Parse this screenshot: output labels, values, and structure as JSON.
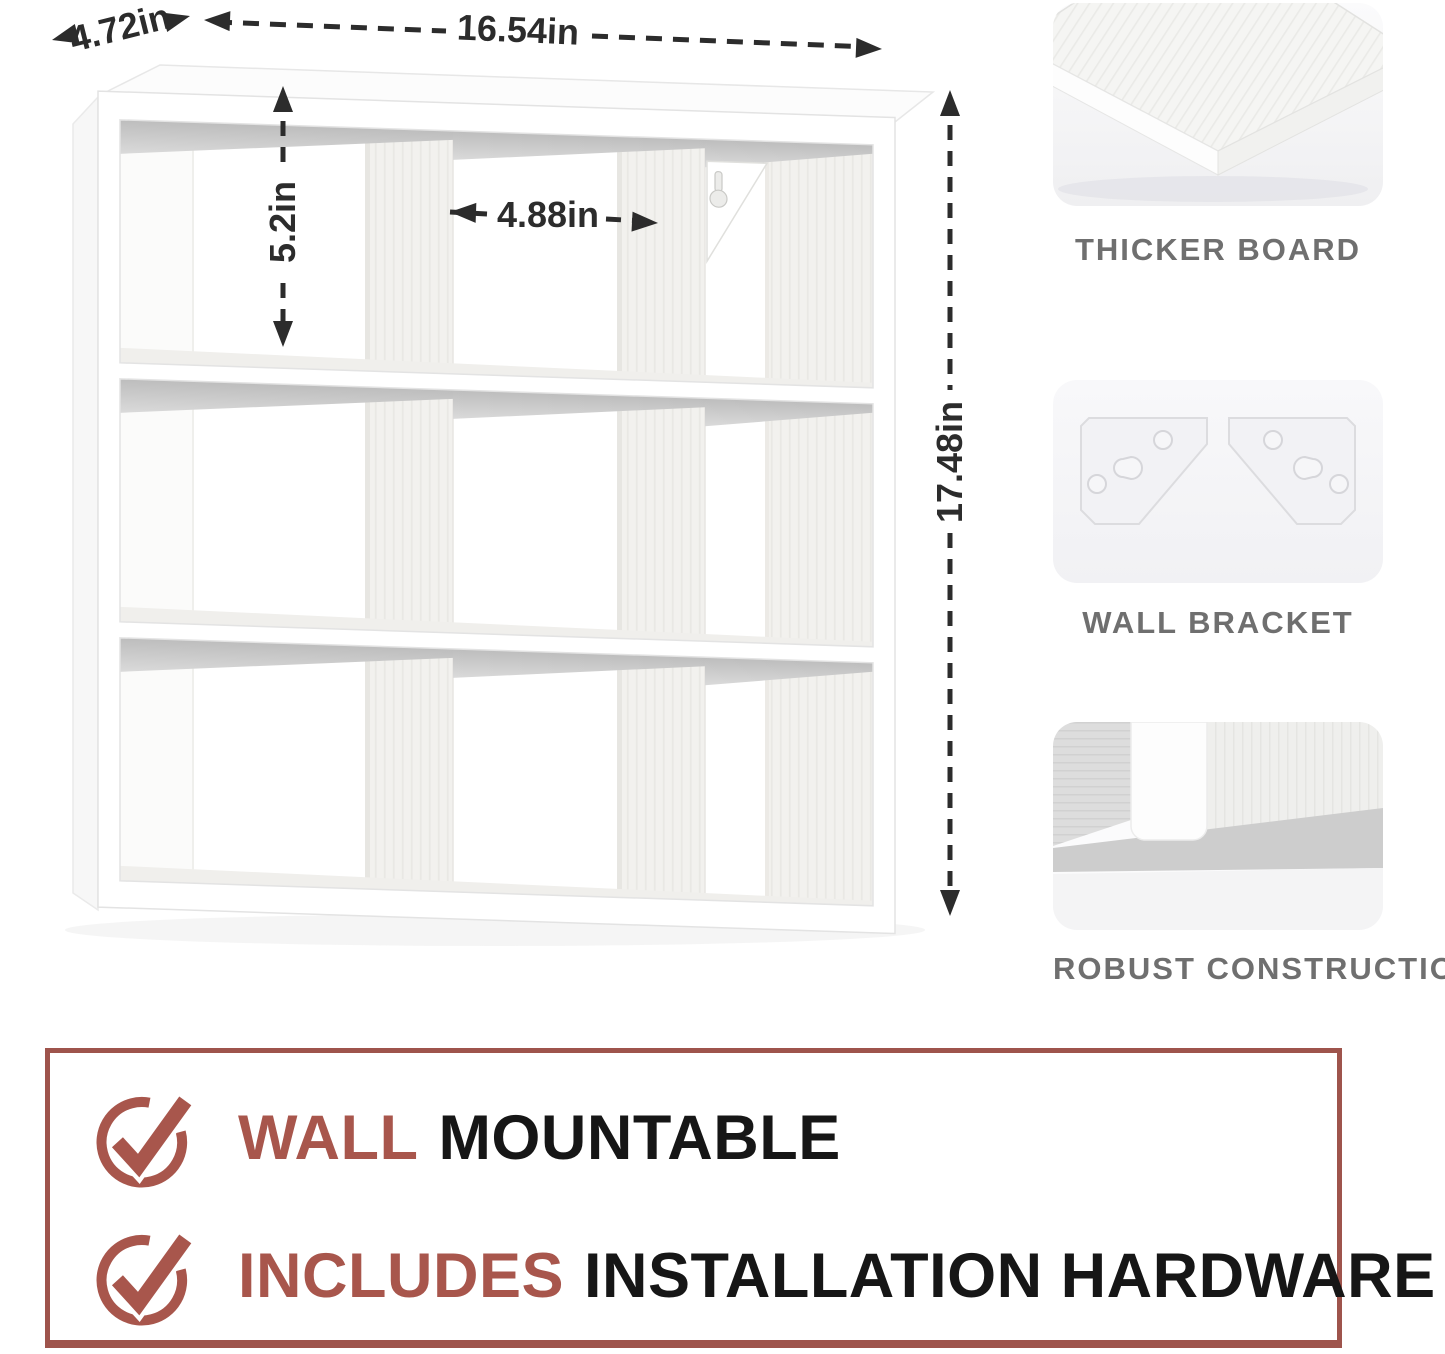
{
  "product": {
    "dimensions": {
      "depth": "4.72in",
      "width": "16.54in",
      "cube_height": "5.2in",
      "cube_width": "4.88in",
      "height": "17.48in"
    },
    "callouts": [
      {
        "label": "THICKER BOARD"
      },
      {
        "label": "WALL BRACKET"
      },
      {
        "label": "ROBUST CONSTRUCTION"
      }
    ],
    "features": [
      {
        "highlight": "WALL",
        "rest": "MOUNTABLE"
      },
      {
        "highlight": "INCLUDES",
        "rest": "INSTALLATION HARDWARE"
      }
    ],
    "colors": {
      "accent_red": "#a8564c",
      "box_border": "#9e544c",
      "label_gray": "#6f6f6f",
      "dimension_text": "#2c2c2c",
      "feature_text": "#161616"
    }
  }
}
